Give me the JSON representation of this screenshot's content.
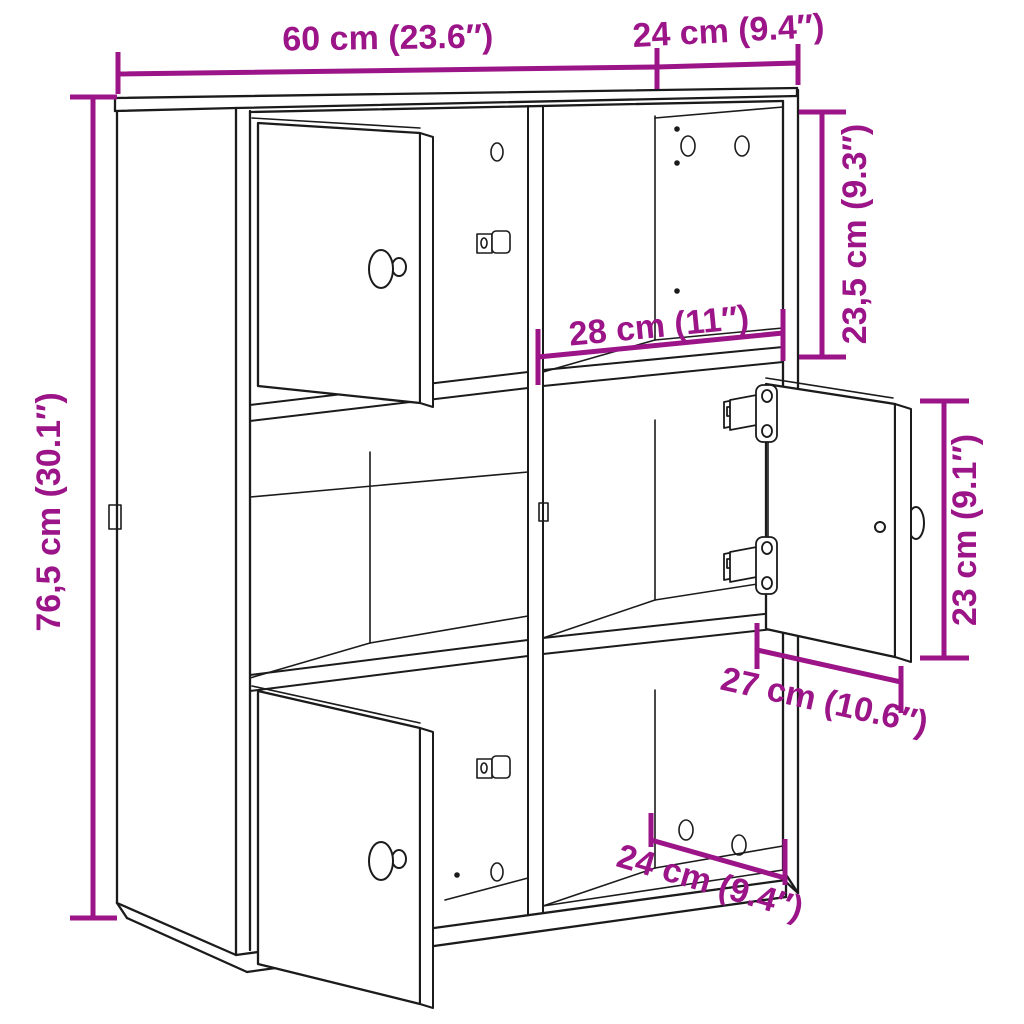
{
  "diagram": {
    "type": "furniture-dimension-diagram",
    "product": "bookcase with 6 compartments and 3 doors",
    "colors": {
      "dimension_accent": "#9B1488",
      "line": "#1b1b1b",
      "background": "#ffffff"
    },
    "dimensions": {
      "top_width": {
        "label": "60 cm (23.6″)"
      },
      "top_depth": {
        "label": "24 cm (9.4″)"
      },
      "overall_height": {
        "label": "76,5 cm (30.1″)"
      },
      "upper_cubby_height": {
        "label": "23,5 cm (9.3″)"
      },
      "cubby_width": {
        "label": "28 cm (11″)"
      },
      "door_height": {
        "label": "23 cm (9.1″)"
      },
      "door_width": {
        "label": "27 cm (10.6″)"
      },
      "bottom_depth": {
        "label": "24 cm (9.4″)"
      }
    }
  }
}
